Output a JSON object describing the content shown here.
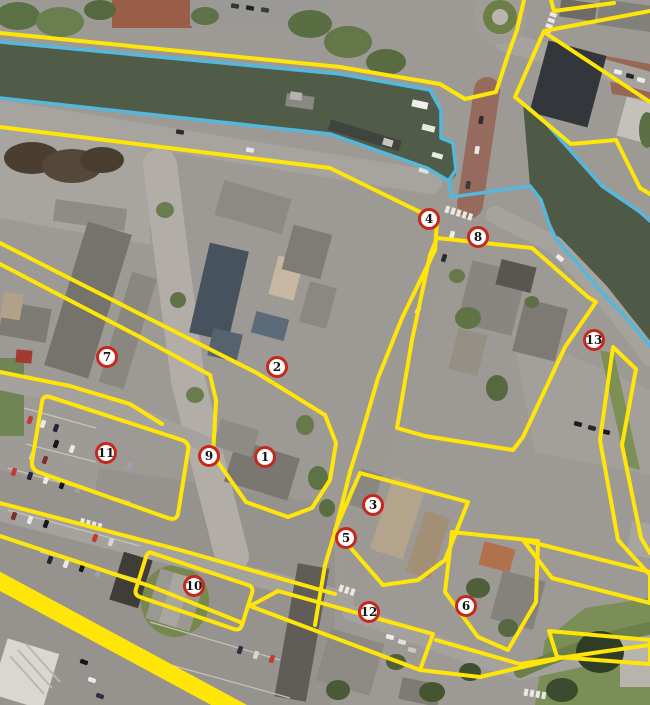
{
  "map": {
    "type": "aerial-annotated-zone-map",
    "colors": {
      "zone_yellow": "#ffe608",
      "water_cyan": "#54b8dc",
      "marker_ring": "#c6281c",
      "marker_fill": "#ffffff",
      "marker_text": "#141414"
    },
    "markers": [
      {
        "label": "1",
        "x": 265,
        "y": 457
      },
      {
        "label": "2",
        "x": 277,
        "y": 367
      },
      {
        "label": "3",
        "x": 373,
        "y": 505
      },
      {
        "label": "4",
        "x": 429,
        "y": 219
      },
      {
        "label": "5",
        "x": 346,
        "y": 538
      },
      {
        "label": "6",
        "x": 466,
        "y": 606
      },
      {
        "label": "7",
        "x": 107,
        "y": 357
      },
      {
        "label": "8",
        "x": 478,
        "y": 237
      },
      {
        "label": "9",
        "x": 209,
        "y": 456
      },
      {
        "label": "10",
        "x": 194,
        "y": 586
      },
      {
        "label": "11",
        "x": 106,
        "y": 453
      },
      {
        "label": "12",
        "x": 369,
        "y": 612
      },
      {
        "label": "13",
        "x": 594,
        "y": 340
      }
    ],
    "overlays": {
      "yellow": [
        {
          "name": "canal-north-bank-line",
          "d": "M0,33 L340,67 L440,84 L465,99 L496,92 L508,55 L517,30 L524,0",
          "width": 4
        },
        {
          "name": "roundabout-corner-line",
          "d": "M551,0 L554,11 L614,3",
          "width": 4
        },
        {
          "name": "northeast-block-outline",
          "d": "M650,11 L544,31 L515,97 L571,144 L616,140 L640,188 L650,194",
          "width": 4
        },
        {
          "name": "northeast-inner-line",
          "d": "M544,32 L650,102",
          "width": 4
        },
        {
          "name": "riverfront-block-outline",
          "d": "M437,238 L532,248 L588,297 L596,302 L565,347 L523,437 L513,450 L425,436 L397,428 L412,340 L430,255 Z",
          "width": 4
        },
        {
          "name": "main-street-west-line",
          "d": "M0,127 L330,168 L420,212 L437,221 L435,250 L402,318 L378,378 L360,440 L350,472 L335,532 L325,565 L315,625",
          "width": 4
        },
        {
          "name": "long-diagonal-and-center-block",
          "d": "M0,243 L140,314 L257,373 L325,415 L336,443 L330,480 L312,508 L288,517 L246,502 L213,455 L216,402",
          "width": 4
        },
        {
          "name": "long-diagonal-2",
          "d": "M0,264 L140,337 L210,375 L216,400",
          "width": 4
        },
        {
          "name": "west-block-south-line",
          "d": "M0,372 L70,386 L130,404 L162,424",
          "width": 4
        },
        {
          "name": "strip-zone-11",
          "d": "M50,397 L182,440 Q190,443 188,451 L178,514 Q176,521 168,518 L38,472 Q31,469 32,461 L42,402 Q43,395 50,397 Z",
          "width": 4
        },
        {
          "name": "strip-zone-10",
          "d": "M152,553 L248,585 Q254,587 252,593 L242,625 Q240,631 234,629 L140,597 Q134,595 136,589 L146,557 Q148,551 152,553 Z",
          "width": 4
        },
        {
          "name": "road-diagonal-north",
          "d": "M0,503 L180,550 L335,594",
          "width": 4
        },
        {
          "name": "road-diagonal-south",
          "d": "M0,536 L150,586 L240,622",
          "width": 4
        },
        {
          "name": "strip-zone-12",
          "d": "M278,591 L433,634 L420,670 L250,606 Z",
          "width": 4
        },
        {
          "name": "road-southeast-line",
          "d": "M436,640 L520,664 L600,652 L650,645",
          "width": 4
        },
        {
          "name": "block-zone-3",
          "d": "M360,473 L468,502 L445,560 L418,580 L383,585 L335,530 Z",
          "width": 4
        },
        {
          "name": "block-zone-6",
          "d": "M452,532 L538,541 L536,602 L508,650 L478,637 L445,592 Z",
          "width": 4
        },
        {
          "name": "strip-zone-13-outer",
          "d": "M636,369 L613,347 L600,440 L618,540 L648,573",
          "width": 4
        },
        {
          "name": "strip-zone-13-inner",
          "d": "M636,369 L622,445 L641,538 L650,553",
          "width": 4
        },
        {
          "name": "strip-southeast-upper",
          "d": "M523,540 L650,572 L650,603 L552,578 Z",
          "width": 4
        },
        {
          "name": "strip-southeast-lower",
          "d": "M549,631 L650,640 L650,664 L557,657 Z",
          "width": 4
        },
        {
          "name": "road-tail-south",
          "d": "M557,659 L480,677 L420,670",
          "width": 4
        },
        {
          "name": "thick-boundary-band",
          "d": "M-8,577 L242,712",
          "width": 17
        }
      ],
      "cyan": [
        {
          "name": "canal-north-waterline",
          "d": "M0,42 L340,74 L430,90 L441,110 L441,138 L453,143 L456,170 L449,180",
          "width": 3.5
        },
        {
          "name": "canal-south-and-river-west-waterline",
          "d": "M0,98 L330,134 L427,168 L449,181 L452,197 L530,186 L541,200 L549,224 L556,239 L601,291 L628,320 L650,346",
          "width": 3.5
        },
        {
          "name": "river-north-waterline",
          "d": "M523,103 L545,122 L602,186 L640,212 L650,221",
          "width": 3.5
        }
      ]
    }
  }
}
